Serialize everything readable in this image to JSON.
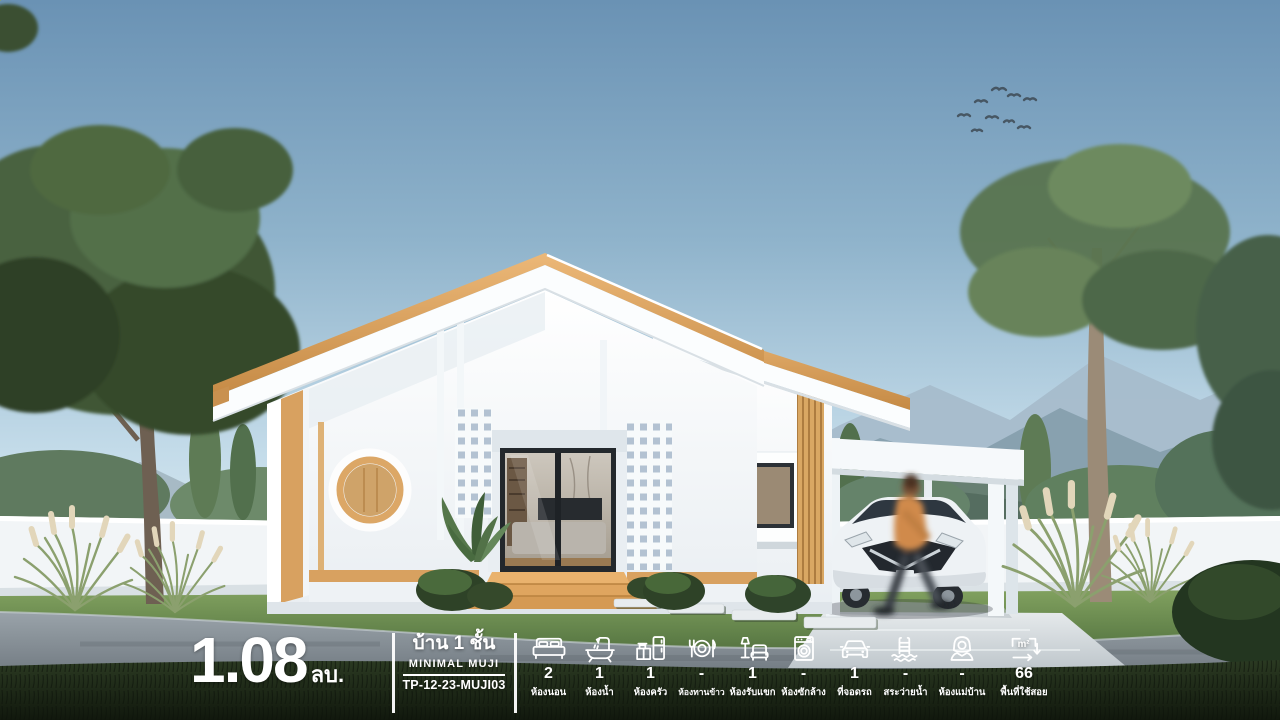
{
  "overlay": {
    "price": {
      "amount": "1.08",
      "unit": "ลบ."
    },
    "title": {
      "thai": "บ้าน 1 ชั้น",
      "brand": "MINIMAL MUJI",
      "model": "TP-12-23-MUJI03"
    },
    "stats": {
      "items": [
        {
          "icon": "bed-icon",
          "value": "2",
          "label": "ห้องนอน"
        },
        {
          "icon": "bathtub-icon",
          "value": "1",
          "label": "ห้องน้ำ"
        },
        {
          "icon": "kitchen-icon",
          "value": "1",
          "label": "ห้องครัว"
        },
        {
          "icon": "dining-icon",
          "value": "-",
          "label": "ห้องทานข้าว"
        },
        {
          "icon": "living-room-icon",
          "value": "1",
          "label": "ห้องรับแขก"
        },
        {
          "icon": "washing-machine-icon",
          "value": "-",
          "label": "ห้องซักล้าง"
        },
        {
          "icon": "car-icon",
          "value": "1",
          "label": "ที่จอดรถ"
        },
        {
          "icon": "pool-icon",
          "value": "-",
          "label": "สระว่ายน้ำ"
        },
        {
          "icon": "maid-icon",
          "value": "-",
          "label": "ห้องแม่บ้าน"
        },
        {
          "icon": "area-icon",
          "value": "66",
          "label": "พื้นที่ใช้สอย",
          "icon_text": "m²"
        }
      ]
    }
  },
  "colors": {
    "text": "#ffffff",
    "sky_top": "#6a92b4",
    "sky_horizon": "#e4f0f5",
    "house_white": "#fbfdfe",
    "wood_trim": "#d8a160",
    "glass_frame": "#24282c",
    "lawn_green": "#6a8a50",
    "foreground_grass": "#1a2414",
    "road_gray": "#939ca4",
    "mountain_haze": "#a7bccb"
  }
}
